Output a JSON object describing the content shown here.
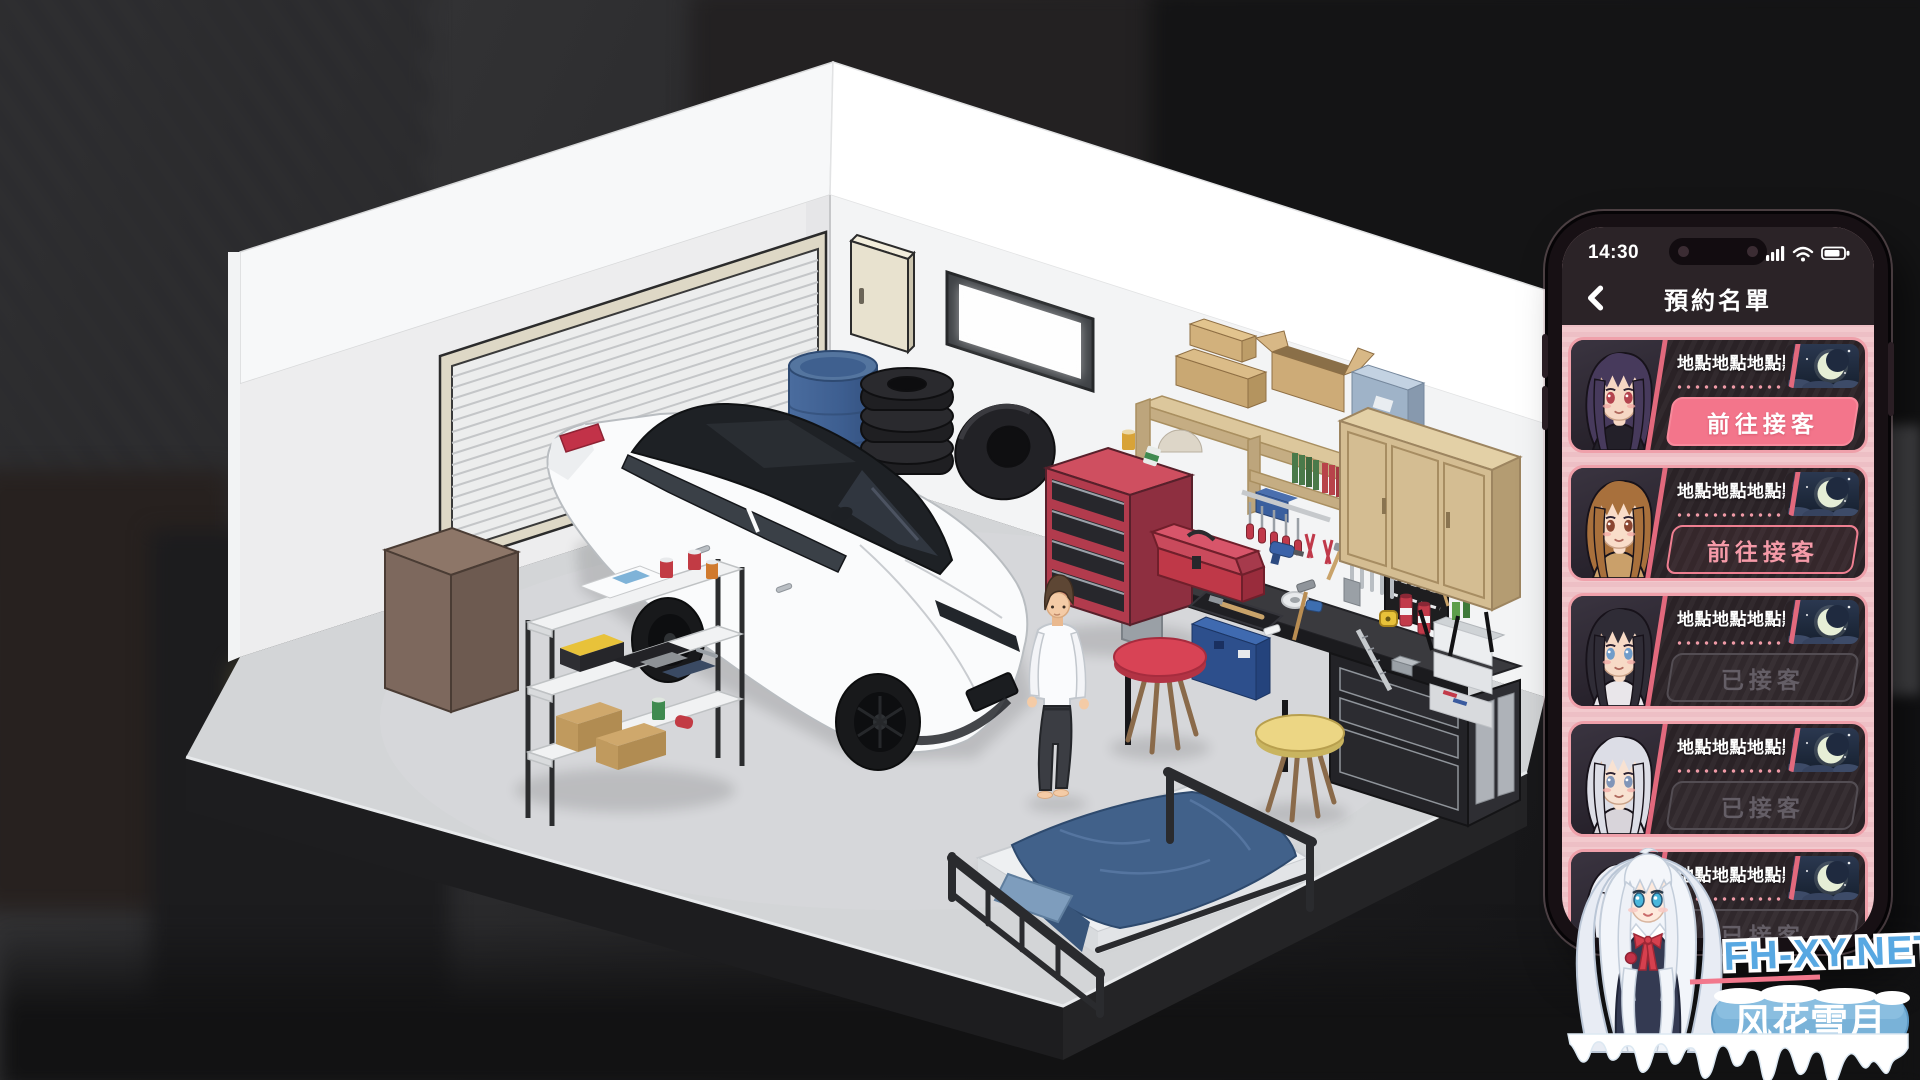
{
  "phone": {
    "status_bar": {
      "time": "14:30",
      "icons": [
        "signal-bars-icon",
        "wifi-icon",
        "battery-icon"
      ]
    },
    "header": {
      "back_icon": "chevron-left-icon",
      "title": "預約名單"
    },
    "colors": {
      "accent_pink": "#f3758b",
      "card_bg": "#2a2226",
      "card_border": "#efa0aa",
      "screen_bg": "#f0c6cb",
      "header_bg": "#2b2327",
      "night_sky": "#1d2739",
      "disabled_text": "#645e66",
      "disabled_border": "#534d53"
    },
    "list": [
      {
        "location": "地點地點地點點",
        "time_icon": "crescent-moon-night-icon",
        "button": {
          "label": "前往接客",
          "state": "active"
        },
        "avatar": {
          "name": "girl-purple-hair",
          "hair": "#473a5c",
          "eye": "#b4434e",
          "outfit": "#232029",
          "skin": "#f6d7c4"
        }
      },
      {
        "location": "地點地點地點點",
        "time_icon": "crescent-moon-night-icon",
        "button": {
          "label": "前往接客",
          "state": "available"
        },
        "avatar": {
          "name": "girl-brown-hair",
          "hair": "#a8703c",
          "eye": "#8a4632",
          "outfit": "#caa06a",
          "skin": "#f9ddc9"
        }
      },
      {
        "location": "地點地點地點點",
        "time_icon": "crescent-moon-night-icon",
        "button": {
          "label": "已接客",
          "state": "done"
        },
        "avatar": {
          "name": "girl-black-hair",
          "hair": "#2f2c36",
          "eye": "#6f9cc9",
          "outfit": "#e9e6ea",
          "skin": "#f7dac6"
        }
      },
      {
        "location": "地點地點地點點",
        "time_icon": "crescent-moon-night-icon",
        "button": {
          "label": "已接客",
          "state": "done"
        },
        "avatar": {
          "name": "girl-silver-hair",
          "hair": "#dcdde6",
          "eye": "#8095b8",
          "outfit": "#d8d4da",
          "skin": "#f8e2d2"
        }
      },
      {
        "location": "地點地點地點點",
        "time_icon": "crescent-moon-night-icon",
        "button": {
          "label": "已接客",
          "state": "done"
        },
        "avatar": {
          "name": "girl-white-hair",
          "hair": "#eef0f6",
          "eye": "#5bb6d9",
          "outfit": "#3a3f55",
          "skin": "#fae6d8"
        }
      }
    ]
  },
  "watermark": {
    "site": "FH-XY.NET",
    "brand": "风花雪月",
    "site_color": "#58a8e2",
    "banner_color": "#79b2d8"
  },
  "scene": {
    "objects": [
      {
        "name": "garage-room",
        "wall": "#f1f2f3",
        "floor": "#d3d5d7"
      },
      {
        "name": "roller-shutter-door",
        "color": "#eceded"
      },
      {
        "name": "window",
        "frame": "#3f4246"
      },
      {
        "name": "electrical-box",
        "color": "#e8e2cf"
      },
      {
        "name": "blue-barrel",
        "color": "#41648f"
      },
      {
        "name": "tire-stack",
        "color": "#222225"
      },
      {
        "name": "white-car",
        "body": "#fafbfc",
        "roof": "#1e2125"
      },
      {
        "name": "mechanic-man",
        "shirt": "#fafbfd",
        "pants": "#3b3d43"
      },
      {
        "name": "storage-rack",
        "shelf": "#f1f2f3"
      },
      {
        "name": "brown-cabinet",
        "color": "#7d685d"
      },
      {
        "name": "red-tool-cart",
        "color": "#b23b4d"
      },
      {
        "name": "red-toolbox",
        "color": "#bf3848"
      },
      {
        "name": "workbench",
        "color": "#3a3a3e"
      },
      {
        "name": "wall-shelf",
        "color": "#c5ad83"
      },
      {
        "name": "wall-cabinet",
        "color": "#d4bd92"
      },
      {
        "name": "blackboard",
        "color": "#1e1e20"
      },
      {
        "name": "red-stool",
        "color": "#d84355"
      },
      {
        "name": "yellow-stool",
        "color": "#ecd684"
      },
      {
        "name": "bed",
        "blanket": "#41618a",
        "mattress": "#eef0f2"
      },
      {
        "name": "blue-toolcase",
        "color": "#2d4f8c"
      }
    ]
  }
}
